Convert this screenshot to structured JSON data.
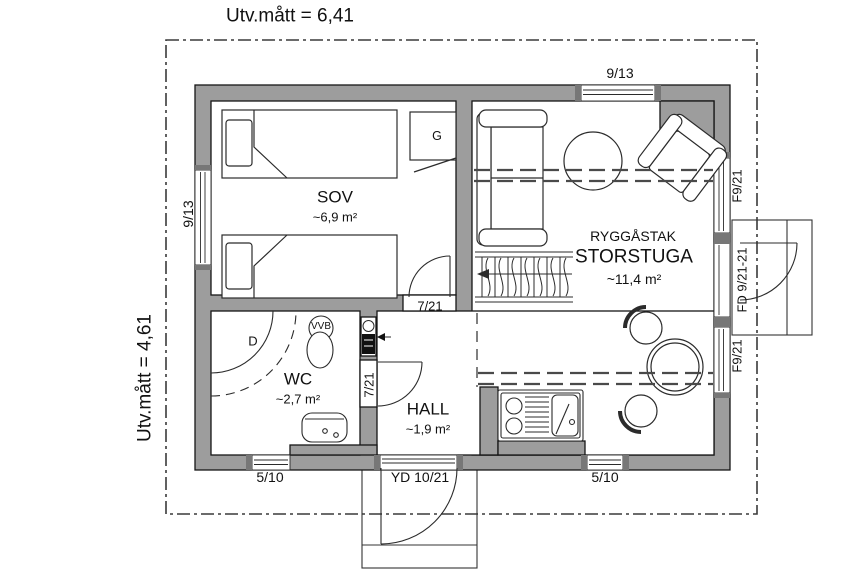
{
  "drawing_type": "floor-plan",
  "colors": {
    "wall_fill": "#9d9d9d",
    "line": "#2b2b2b",
    "background": "#ffffff"
  },
  "dimensions": {
    "top": "Utv.mått = 6,41",
    "left": "Utv.mått = 4,61"
  },
  "rooms": {
    "sov": {
      "name": "SOV",
      "area": "~6,9 m²"
    },
    "storstuga": {
      "ceiling": "RYGGÅSTAK",
      "name": "STORSTUGA",
      "area": "~11,4 m²"
    },
    "wc": {
      "name": "WC",
      "area": "~2,7 m²"
    },
    "hall": {
      "name": "HALL",
      "area": "~1,9 m²"
    }
  },
  "openings": {
    "window_top": "9/13",
    "window_left": "9/13",
    "window_right_upper": "F9/21",
    "door_right": "FD 9/21-21",
    "window_right_lower": "F9/21",
    "window_bottom_left": "5/10",
    "window_bottom_right": "5/10",
    "entry_door": "YD 10/21",
    "sov_door": "7/21",
    "wc_door": "7/21"
  },
  "fixtures": {
    "wardrobe": "G",
    "shower": "D",
    "water_heater": "VVB"
  }
}
